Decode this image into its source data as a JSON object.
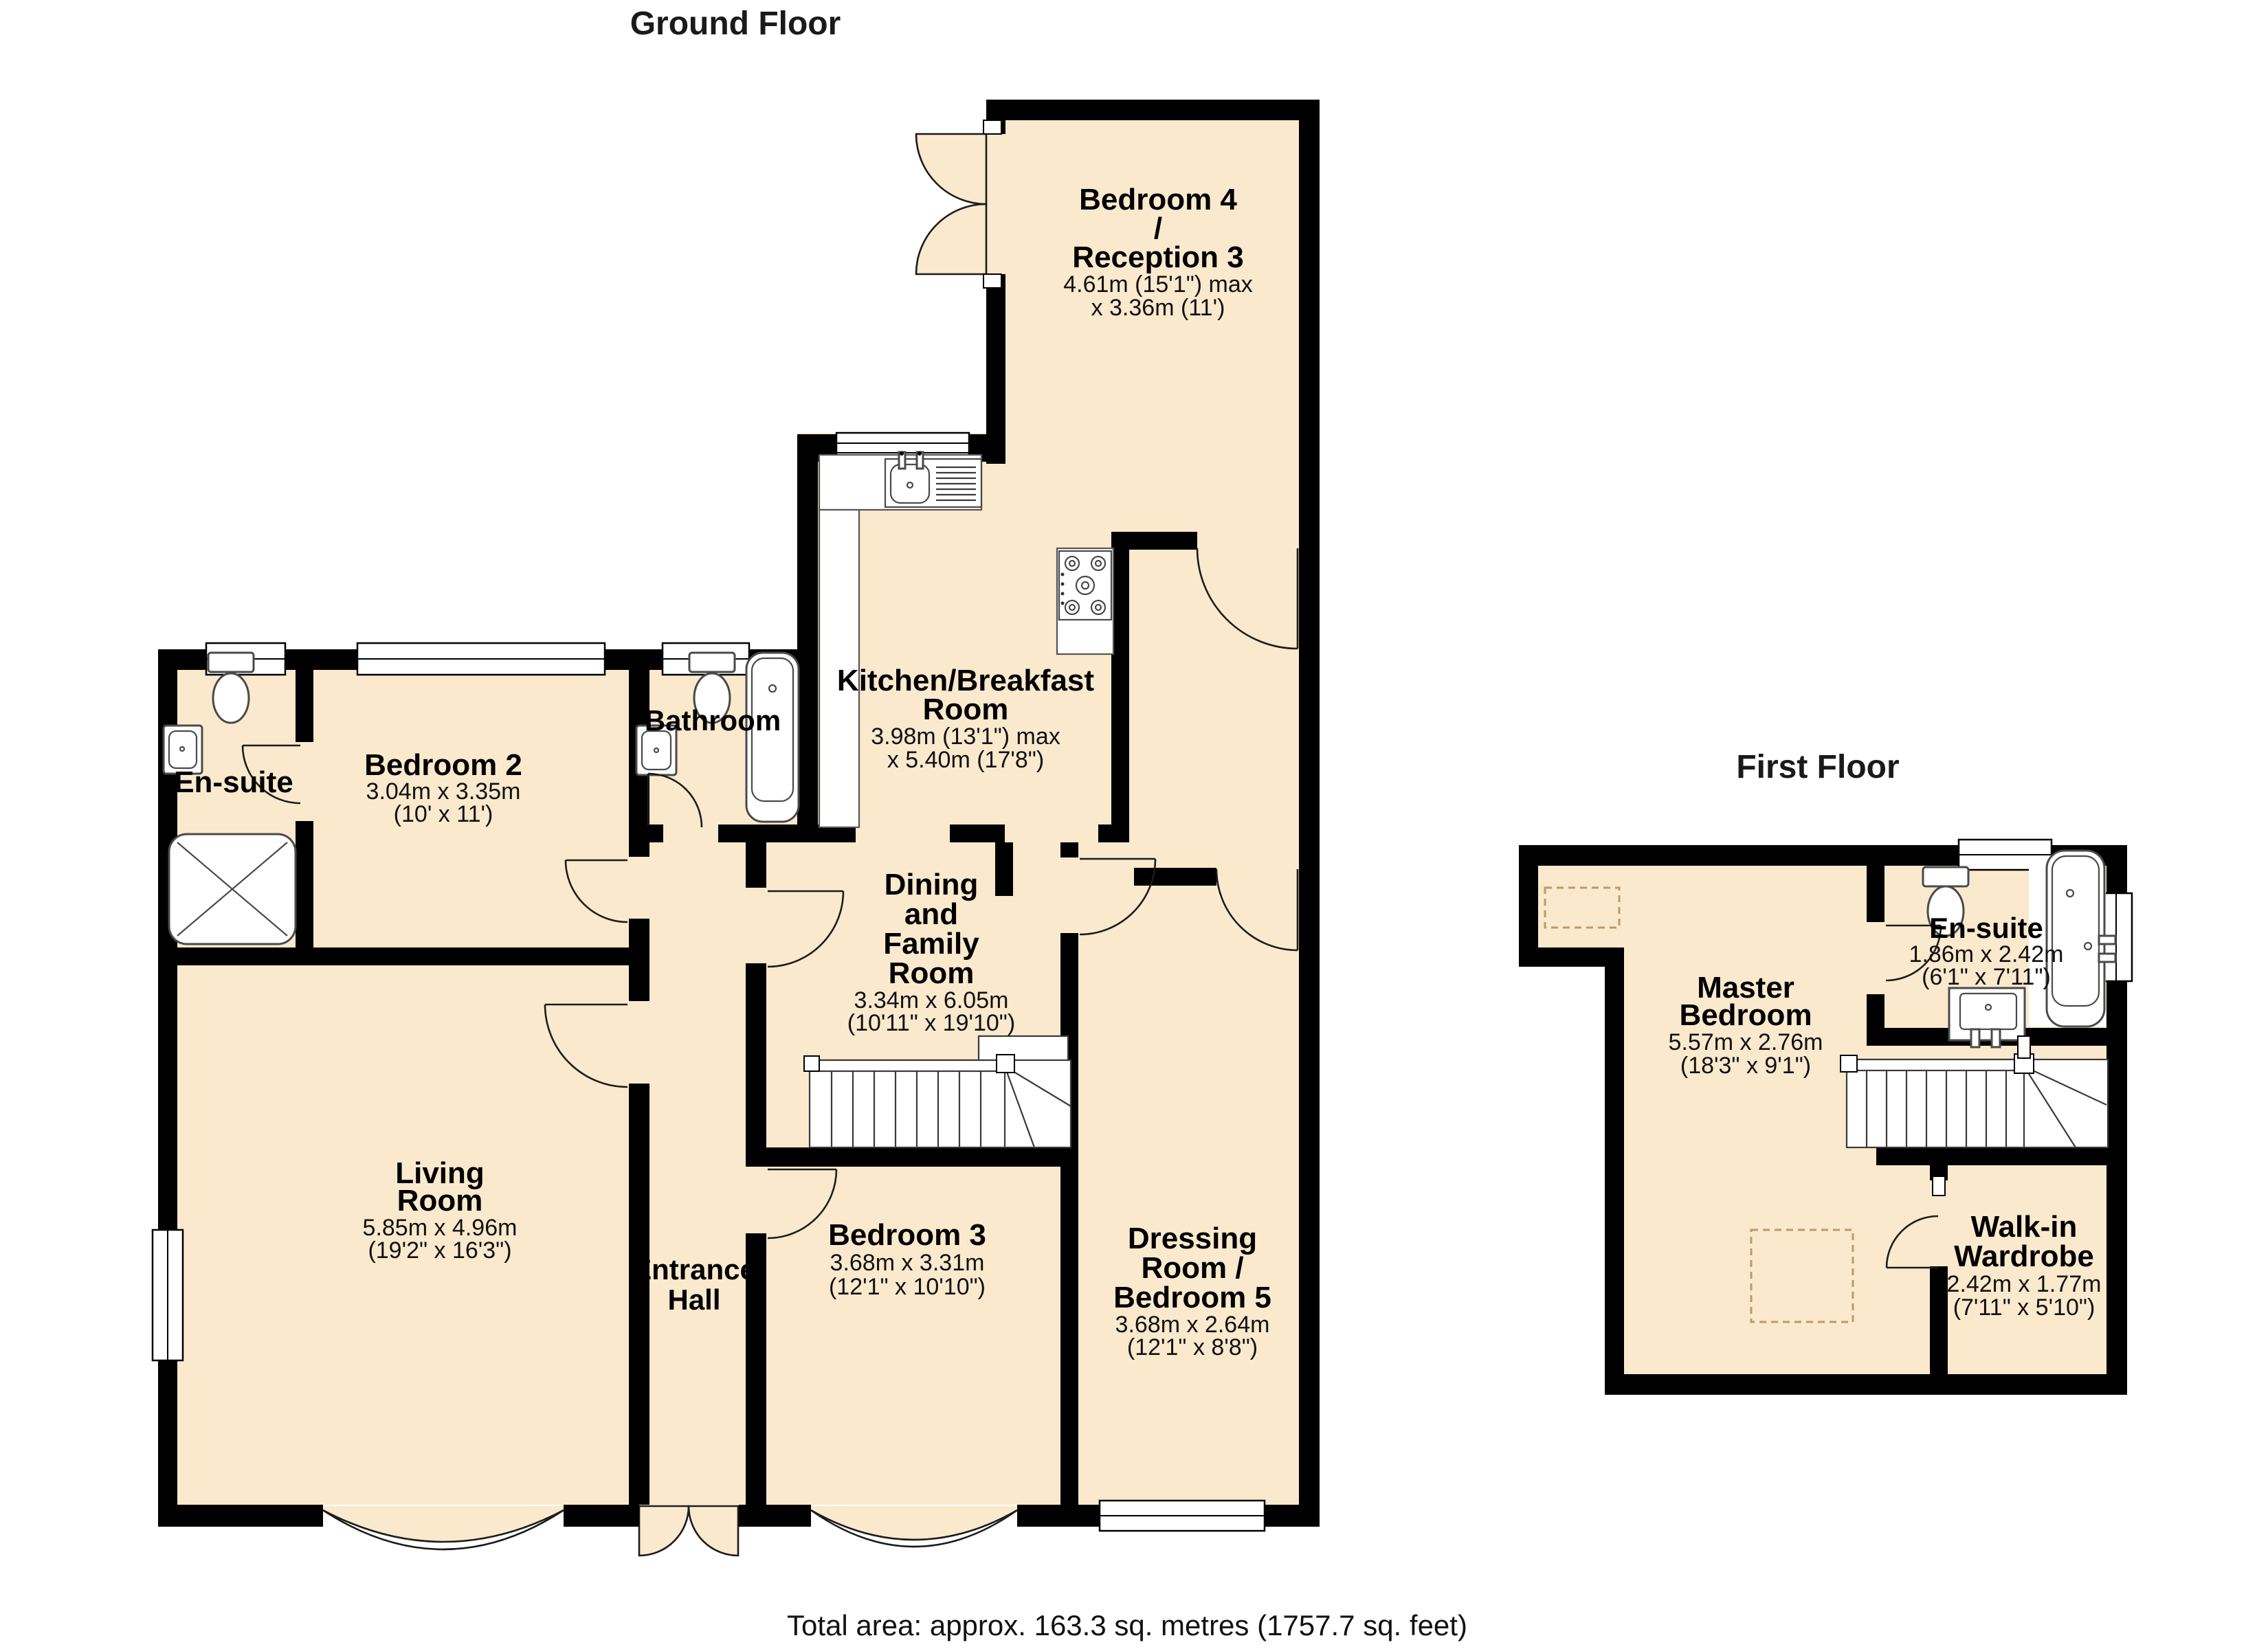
{
  "titles": {
    "ground": "Ground Floor",
    "first": "First Floor"
  },
  "footer": {
    "total_area": "Total area: approx. 163.3 sq. metres (1757.7 sq. feet)"
  },
  "colors": {
    "room_fill": "#FAE9CD",
    "wall": "#000000"
  },
  "ground_rooms": {
    "bedroom4": {
      "name": [
        "Bedroom 4",
        "/",
        "Reception 3"
      ],
      "dims": [
        "4.61m (15'1\") max",
        "x 3.36m (11')"
      ]
    },
    "kitchen": {
      "name": [
        "Kitchen/Breakfast",
        "Room"
      ],
      "dims": [
        "3.98m (13'1\") max",
        "x 5.40m (17'8\")"
      ]
    },
    "bathroom": {
      "name": [
        "Bathroom"
      ],
      "dims": []
    },
    "ensuite": {
      "name": [
        "En-suite"
      ],
      "dims": []
    },
    "bedroom2": {
      "name": [
        "Bedroom 2"
      ],
      "dims": [
        "3.04m x 3.35m",
        "(10' x 11')"
      ]
    },
    "living": {
      "name": [
        "Living",
        "Room"
      ],
      "dims": [
        "5.85m x 4.96m",
        "(19'2\" x 16'3\")"
      ]
    },
    "hall": {
      "name": [
        "Entrance",
        "Hall"
      ],
      "dims": []
    },
    "dining": {
      "name": [
        "Dining",
        "and",
        "Family",
        "Room"
      ],
      "dims": [
        "3.34m x 6.05m",
        "(10'11\" x 19'10\")"
      ]
    },
    "bedroom3": {
      "name": [
        "Bedroom 3"
      ],
      "dims": [
        "3.68m x 3.31m",
        "(12'1\" x 10'10\")"
      ]
    },
    "dressing": {
      "name": [
        "Dressing",
        "Room /",
        "Bedroom 5"
      ],
      "dims": [
        "3.68m x 2.64m",
        "(12'1\" x 8'8\")"
      ]
    }
  },
  "first_rooms": {
    "master": {
      "name": [
        "Master",
        "Bedroom"
      ],
      "dims": [
        "5.57m x 2.76m",
        "(18'3\" x 9'1\")"
      ]
    },
    "ensuite": {
      "name": [
        "En-suite"
      ],
      "dims": [
        "1.86m x 2.42m",
        "(6'1\" x 7'11\")"
      ]
    },
    "wardrobe": {
      "name": [
        "Walk-in",
        "Wardrobe"
      ],
      "dims": [
        "2.42m x 1.77m",
        "(7'11\" x 5'10\")"
      ]
    }
  }
}
